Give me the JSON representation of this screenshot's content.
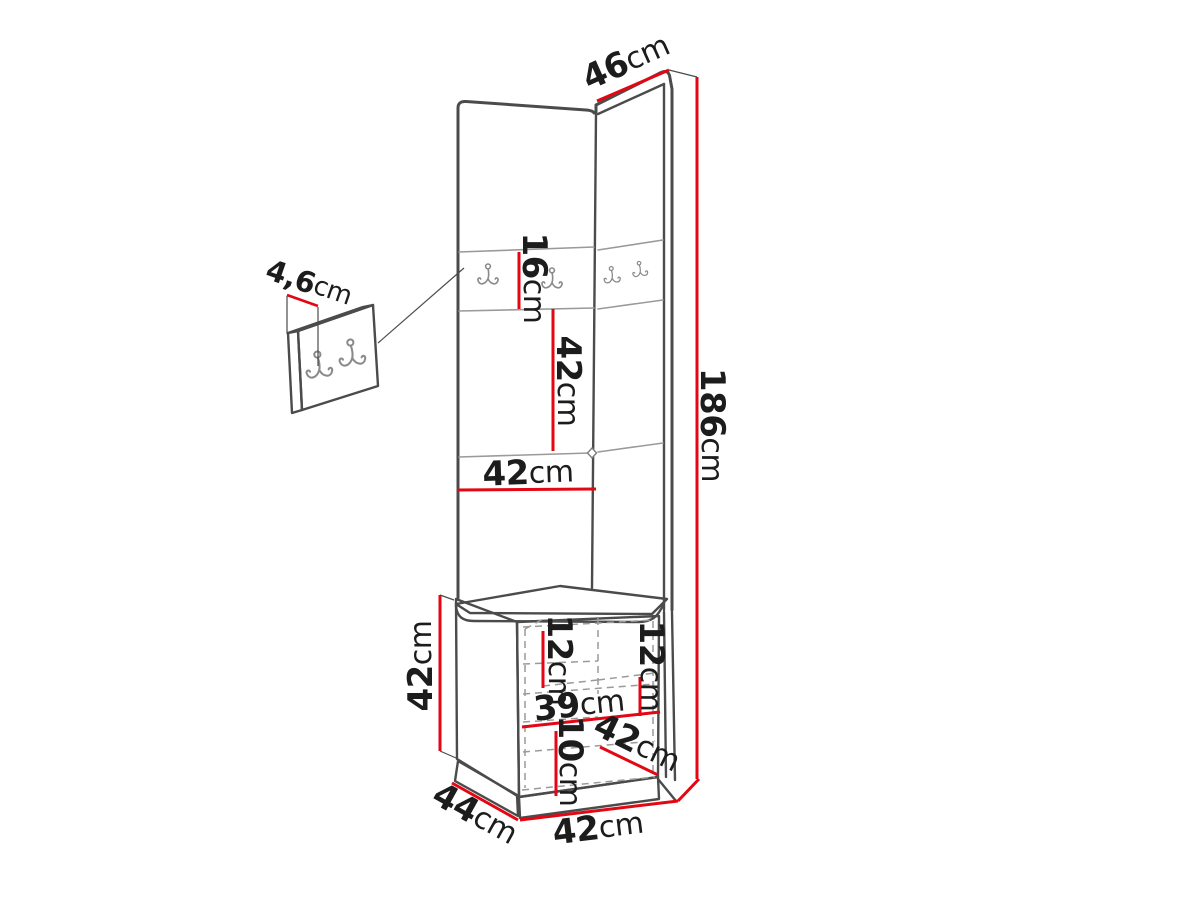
{
  "diagram": {
    "title": "hallway-corner-wardrobe-dimension-drawing",
    "colors": {
      "background": "#ffffff",
      "line": "#4b4b4b",
      "seam": "#9a9a9a",
      "accent": "#e30613",
      "text": "#1c1c1c",
      "hook": "#8a8a8a"
    },
    "icons": {
      "coat_hook": "double-coat-hook-icon"
    },
    "labels": {
      "top_depth": {
        "value": "46",
        "unit": "cm"
      },
      "wall_panel_thickness": {
        "value": "4,6",
        "unit": "cm"
      },
      "hook_row_height": {
        "value": "16",
        "unit": "cm"
      },
      "middle_section_height": {
        "value": "42",
        "unit": "cm"
      },
      "panel_width": {
        "value": "42",
        "unit": "cm"
      },
      "total_height": {
        "value": "186",
        "unit": "cm"
      },
      "bench_height": {
        "value": "42",
        "unit": "cm"
      },
      "bench_left_shelf": {
        "value": "12",
        "unit": "cm"
      },
      "bench_right_shelf": {
        "value": "12",
        "unit": "cm"
      },
      "bench_inner_width": {
        "value": "39",
        "unit": "cm"
      },
      "bench_bottom_gap": {
        "value": "10",
        "unit": "cm"
      },
      "bench_depth": {
        "value": "42",
        "unit": "cm"
      },
      "base_depth": {
        "value": "44",
        "unit": "cm"
      },
      "bench_width": {
        "value": "42",
        "unit": "cm"
      }
    }
  }
}
